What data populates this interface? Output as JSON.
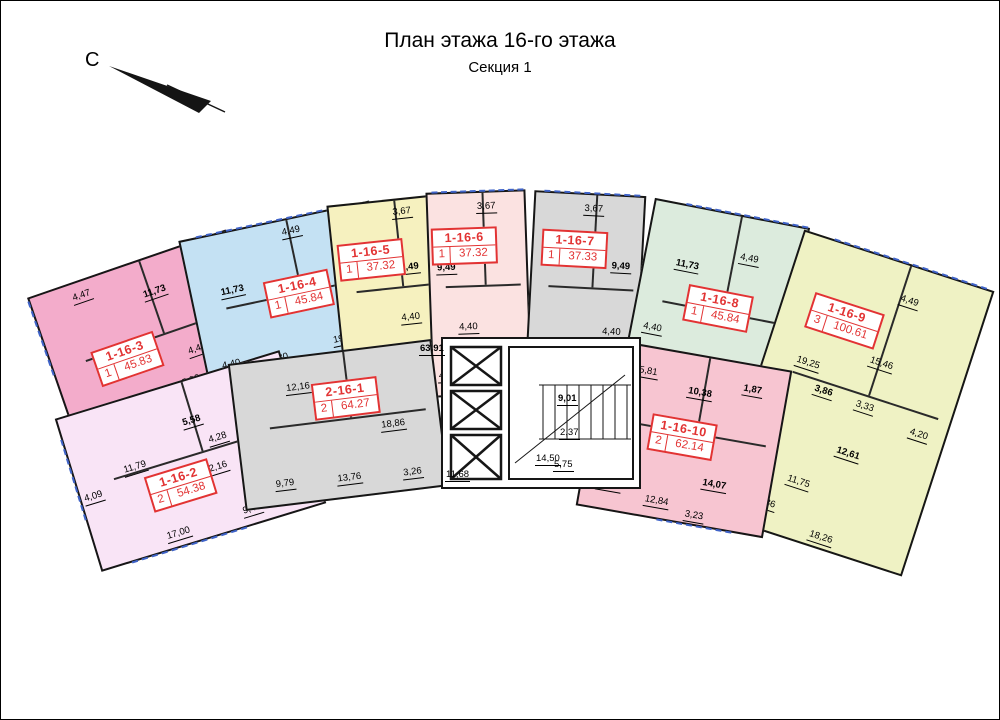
{
  "page": {
    "title": "План этажа 16-го этажа",
    "subtitle": "Секция 1",
    "north_label": "С"
  },
  "colors": {
    "wall": "#161616",
    "balcony_line": "#3f63c8",
    "label_box": "#e23333"
  },
  "apartments": [
    {
      "id": "1-16-2",
      "rooms": "2",
      "area": "54.38",
      "color": "#f9e4f6",
      "dims": [
        "5,58",
        "11,79",
        "4,09",
        "4,28",
        "4,28",
        "2,16",
        "2,16",
        "9,48",
        "17,00"
      ]
    },
    {
      "id": "1-16-3",
      "rooms": "1",
      "area": "45.83",
      "color": "#f3accb",
      "dims": [
        "4,47",
        "11,73",
        "4,40",
        "4,40",
        "5,30",
        "19,93"
      ]
    },
    {
      "id": "1-16-4",
      "rooms": "1",
      "area": "45.84",
      "color": "#c4e1f3",
      "dims": [
        "4,49",
        "11,73",
        "4,40",
        "5,30",
        "19,92"
      ]
    },
    {
      "id": "1-16-5",
      "rooms": "1",
      "area": "37.32",
      "color": "#f6f1bf",
      "dims": [
        "3,67",
        "9,49",
        "4,40",
        "4,17",
        "15,59"
      ]
    },
    {
      "id": "1-16-6",
      "rooms": "1",
      "area": "37.32",
      "color": "#fbe2e1",
      "dims": [
        "3,67",
        "9,49",
        "4,40",
        "4,17",
        "15,59"
      ]
    },
    {
      "id": "1-16-7",
      "rooms": "1",
      "area": "37.33",
      "color": "#d8d8d8",
      "dims": [
        "3,67",
        "9,49",
        "4,40",
        "4,17",
        "15,60"
      ]
    },
    {
      "id": "1-16-8",
      "rooms": "1",
      "area": "45.84",
      "color": "#dcebdd",
      "dims": [
        "4,49",
        "11,73",
        "4,40",
        "5,29",
        "19,93"
      ]
    },
    {
      "id": "1-16-9",
      "rooms": "3",
      "area": "100.61",
      "color": "#eff2c4",
      "dims": [
        "4,49",
        "19,25",
        "15,46",
        "3,86",
        "3,33",
        "4,04",
        "4,20",
        "12,61",
        "11,75",
        "3,36",
        "18,26"
      ]
    },
    {
      "id": "1-16-10",
      "rooms": "2",
      "area": "62.14",
      "color": "#f7c5d1",
      "dims": [
        "5,81",
        "10,38",
        "1,87",
        "13,94",
        "12,84",
        "14,07",
        "3,23"
      ]
    },
    {
      "id": "2-16-1",
      "rooms": "2",
      "area": "64.27",
      "color": "#d8d8d8",
      "dims": [
        "12,16",
        "18,86",
        "13,76",
        "3,26",
        "9,79"
      ]
    }
  ],
  "core": {
    "dims": [
      "63,91",
      "11,68",
      "14,50",
      "9,01",
      "2,37",
      "5,75"
    ]
  }
}
